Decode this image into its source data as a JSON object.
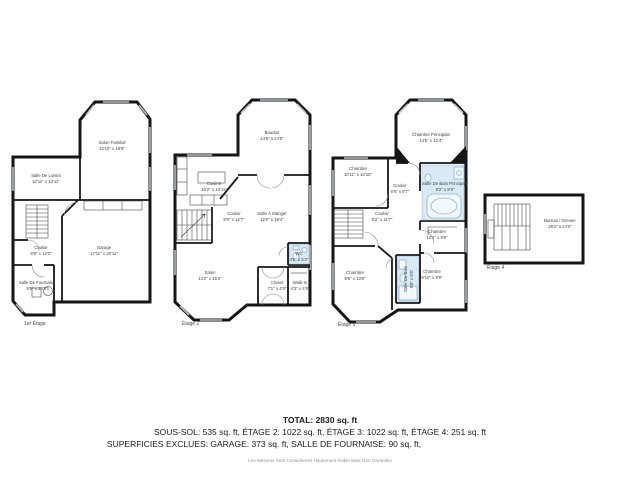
{
  "colors": {
    "wall": "#161616",
    "window_marker": "#b9c2c9",
    "bathroom_fill": "#d9eaf6",
    "fixture_stroke": "#8ab4d2",
    "summary_text": "#1c1c1c",
    "room_label_text": "#3d3d3d"
  },
  "plans": [
    {
      "caption": "1er Étage",
      "rooms": [
        {
          "name": "Salon Familial",
          "dims": "13'10\" x 19'9\""
        },
        {
          "name": "Salle De Loisirs",
          "dims": "10'11\" x 10'11\""
        },
        {
          "name": "Couloir",
          "dims": "9'9\" x 12'0\""
        },
        {
          "name": "Garage",
          "dims": "17'11\" x 20'11\""
        },
        {
          "name": "Salle De Fournaise",
          "dims": "9'9\" x 10'2\""
        }
      ]
    },
    {
      "caption": "Étage 2",
      "rooms": [
        {
          "name": "Boudoir",
          "dims": "14'5\" x 14'5\""
        },
        {
          "name": "Cuisine",
          "dims": "16'2\" x 10'11\""
        },
        {
          "name": "Couloir",
          "dims": "8'0\" x 12'7\""
        },
        {
          "name": "Salle À Manger",
          "dims": "12'0\" x 19'4\""
        },
        {
          "name": "Salon",
          "dims": "14'2\" x 15'2\""
        },
        {
          "name": "WC",
          "dims": "4'5\" x 5'2\""
        },
        {
          "name": "Closet",
          "dims": "7'1\" x 4'9\""
        },
        {
          "name": "Walk-In",
          "dims": "4'3\" x 4'9\""
        }
      ]
    },
    {
      "caption": "Étage 3",
      "rooms": [
        {
          "name": "Chambre Principale",
          "dims": "14'5\" x 12'4\""
        },
        {
          "name": "Chambre",
          "dims": "10'11\" x 10'10\""
        },
        {
          "name": "Couloir",
          "dims": "6'6\" x 8'7\""
        },
        {
          "name": "Salle De Bain Principale",
          "dims": "8'2\" x 9'3\""
        },
        {
          "name": "Couloir",
          "dims": "9'2\" x 11'7\""
        },
        {
          "name": "Chambre",
          "dims": "12'2\" x 9'9\""
        },
        {
          "name": "Chambre",
          "dims": "9'6\" x 13'8\""
        },
        {
          "name": "Salle De Bain",
          "dims": "5'0\" x 9'6\""
        },
        {
          "name": "Chambre",
          "dims": "9'10\" x 9'9\""
        }
      ]
    },
    {
      "caption": "Étage 4",
      "rooms": [
        {
          "name": "Bureau / Grenier",
          "dims": "28'2\" x 14'0\""
        }
      ]
    }
  ],
  "summary": {
    "total": "TOTAL: 2830 sq. ft",
    "floors": "SOUS-SOL: 535 sq. ft, ÉTAGE 2: 1022 sq. ft, ÉTAGE 3: 1022 sq. ft, ÉTAGE 4: 251 sq. ft",
    "exclusions": "SUPERFICIES EXCLUES: GARAGE: 373 sq. ft, SALLE DE FOURNAISE: 90 sq. ft,",
    "disclaimer": "Les Mesures Sont Considerees Hautement Fiable Mais Non Garanties"
  }
}
